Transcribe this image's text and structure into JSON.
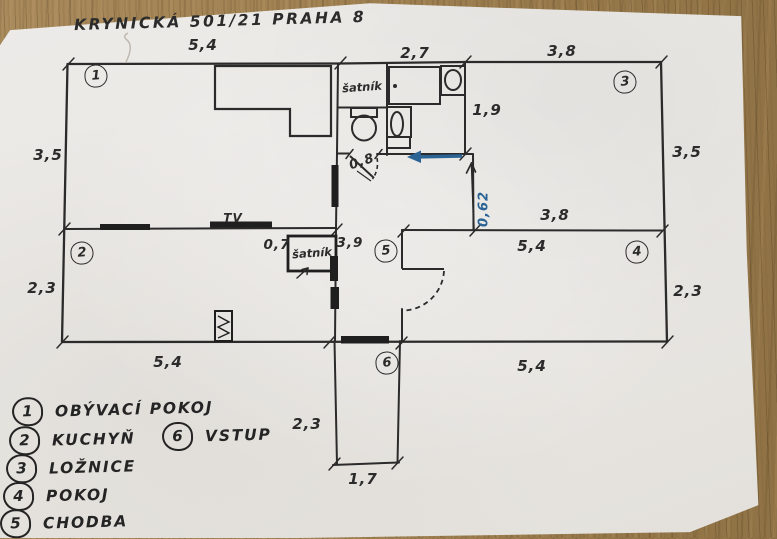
{
  "title": "KRYNICKÁ 501/21 PRAHA 8",
  "legend": {
    "items": [
      {
        "num": "1",
        "label": "OBÝVACÍ POKOJ"
      },
      {
        "num": "2",
        "label": "KUCHYŇ"
      },
      {
        "num": "3",
        "label": "LOŽNICE"
      },
      {
        "num": "4",
        "label": "POKOJ"
      },
      {
        "num": "5",
        "label": "CHODBA"
      },
      {
        "num": "6",
        "label": "VSTUP"
      }
    ]
  },
  "plan": {
    "labels": {
      "tv": "TV",
      "closet_upper": "šatník",
      "closet_lower": "šatník"
    },
    "dimensions": {
      "top_left": "5,4",
      "top_middle": "2,7",
      "top_right": "3,8",
      "left_upper": "3,5",
      "left_lower": "2,3",
      "right_upper": "3,5",
      "right_lower": "2,3",
      "bath_depth": "1,9",
      "bath_door": "0,8",
      "wall_offset": "0,62",
      "closet_depth": "0,7",
      "hall_length": "3,9",
      "mid_right_upper": "3,8",
      "mid_right_lower": "5,4",
      "bottom_left": "5,4",
      "bottom_right": "5,4",
      "entry_length": "2,3",
      "entry_width": "1,7"
    }
  },
  "colors": {
    "ink": "#2b2b2b",
    "blue_ink": "#2b6394",
    "paper": "#e9e7e3",
    "wood": "#9c7e50"
  }
}
